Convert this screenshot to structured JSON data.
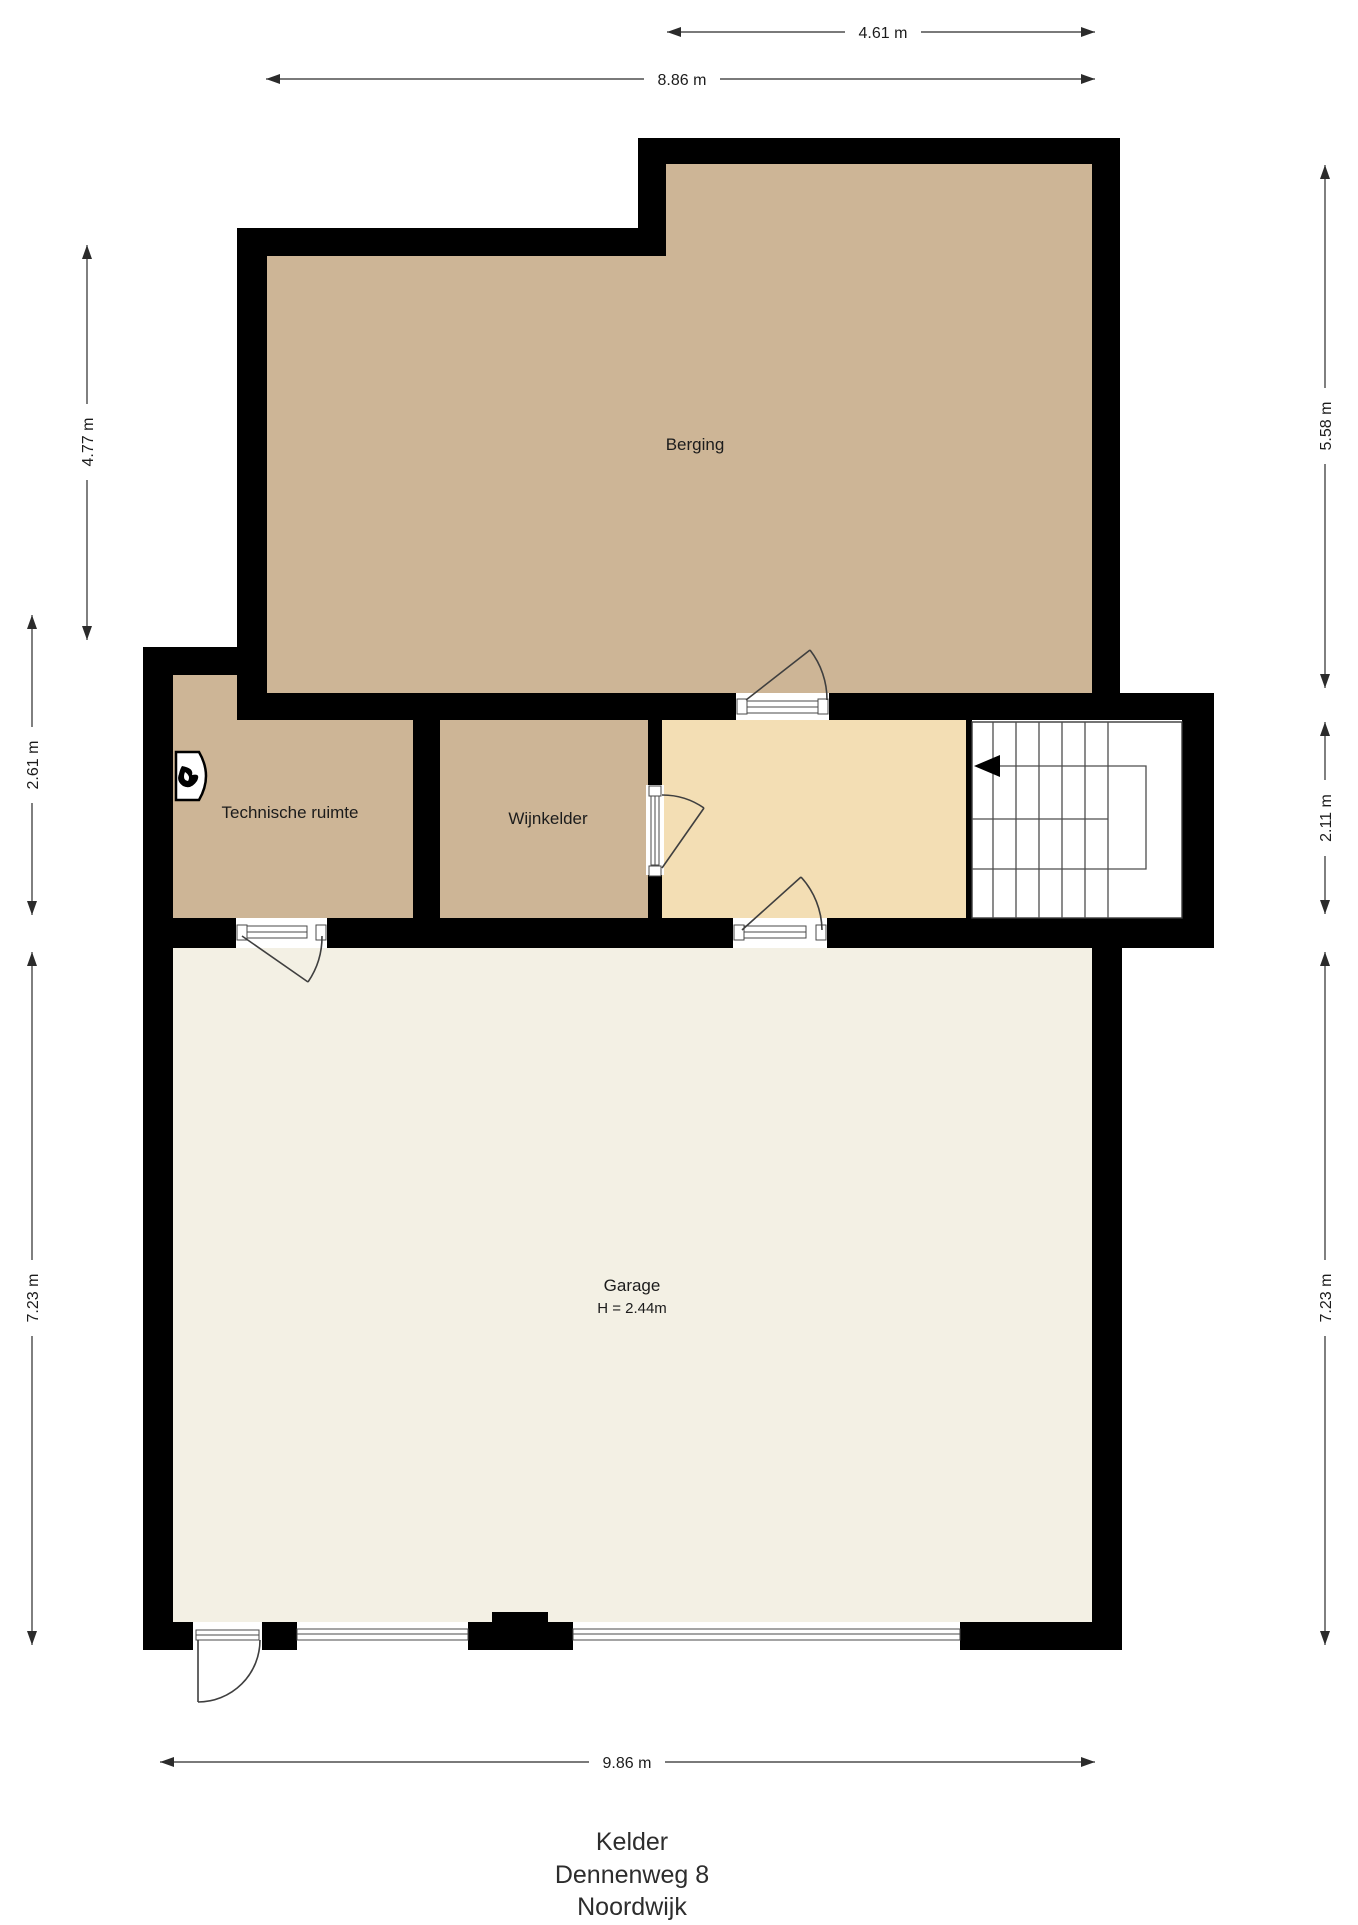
{
  "plan": {
    "type": "floorplan",
    "title_lines": [
      "Kelder",
      "Dennenweg 8",
      "Noordwijk"
    ],
    "rooms": {
      "berging": {
        "label": "Berging"
      },
      "technische_ruimte": {
        "label": "Technische ruimte"
      },
      "wijnkelder": {
        "label": "Wijnkelder"
      },
      "garage": {
        "label": "Garage",
        "height_note": "H = 2.44m"
      }
    },
    "dimensions": {
      "top_inner": "4.61 m",
      "top_outer": "8.86 m",
      "left_upper": "4.77 m",
      "left_middle": "2.61 m",
      "left_lower": "7.23 m",
      "right_upper": "5.58 m",
      "right_middle": "2.11 m",
      "right_lower": "7.23 m",
      "bottom": "9.86 m"
    },
    "icons": {
      "boiler": "boiler-icon",
      "stair_direction": "stair-direction-arrow-left"
    },
    "colors": {
      "wall": "#000000",
      "room_tan": "#cdb596",
      "hall_cream": "#f3deb4",
      "garage_ivory": "#f3f0e4",
      "stair_line": "#4d4d4d",
      "text": "#1c1c1c"
    }
  }
}
